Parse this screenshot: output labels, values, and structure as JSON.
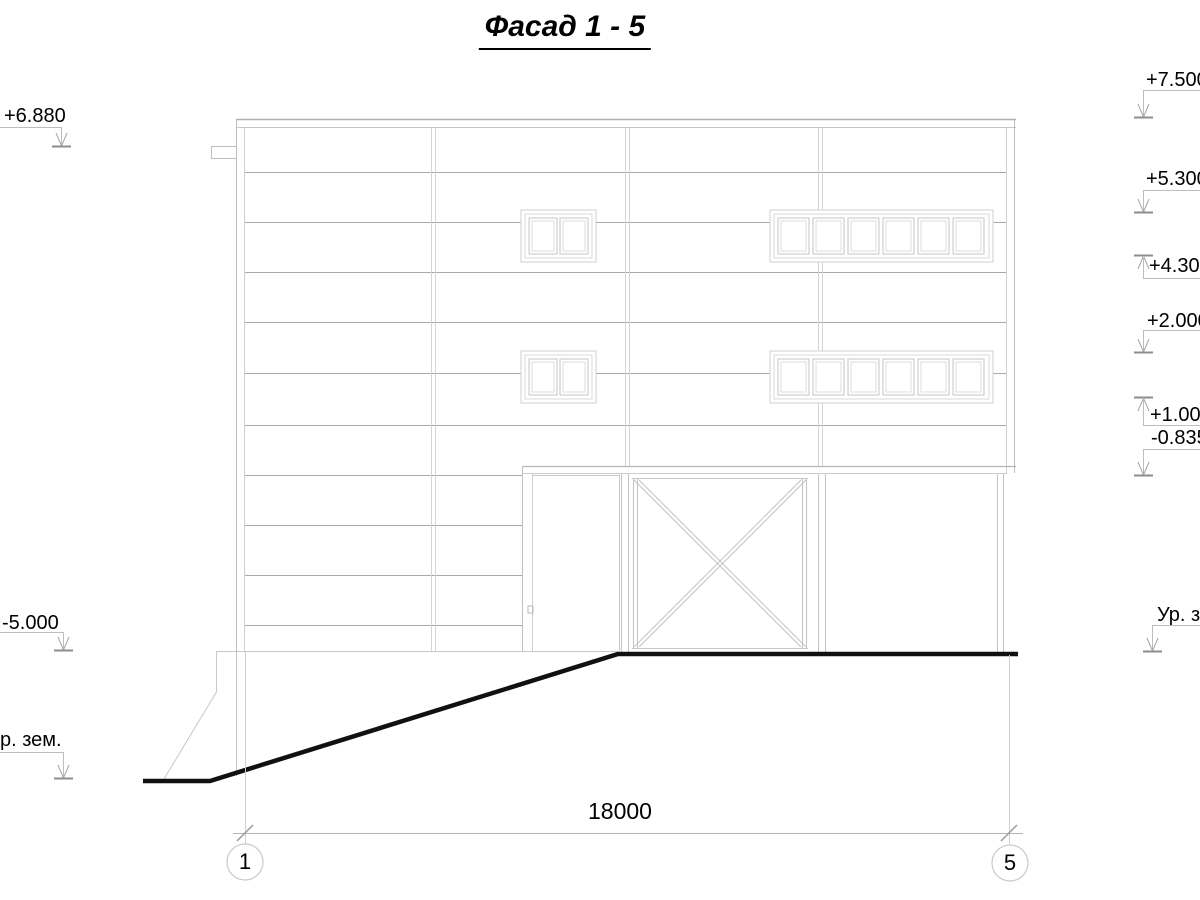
{
  "title": "Фасад 1 - 5",
  "dimension": {
    "label": "18000"
  },
  "axis_bubbles": {
    "left": "1",
    "right": "5"
  },
  "elevation_markers": {
    "left": [
      {
        "label": "+6.880",
        "direction": "down"
      },
      {
        "label": "-5.000",
        "direction": "down"
      },
      {
        "label": "р. зем.",
        "direction": "down"
      }
    ],
    "right": [
      {
        "label": "+7.500",
        "direction": "down"
      },
      {
        "label": "+5.300",
        "direction": "down"
      },
      {
        "label": "+4.300",
        "direction": "up"
      },
      {
        "label": "+2.000",
        "direction": "down"
      },
      {
        "label": "+1.000",
        "direction": "up"
      },
      {
        "label": "-0.835",
        "direction": "down"
      },
      {
        "label": "Ур. зем.",
        "direction": "down"
      }
    ]
  },
  "colors": {
    "siding_line": "#a9a9a9",
    "edge_gray": "#bdbdbd",
    "light_gray": "#d2d2d2",
    "marker_gray": "#a6a6a6",
    "ground_line": "#111111",
    "text": "#000000"
  }
}
